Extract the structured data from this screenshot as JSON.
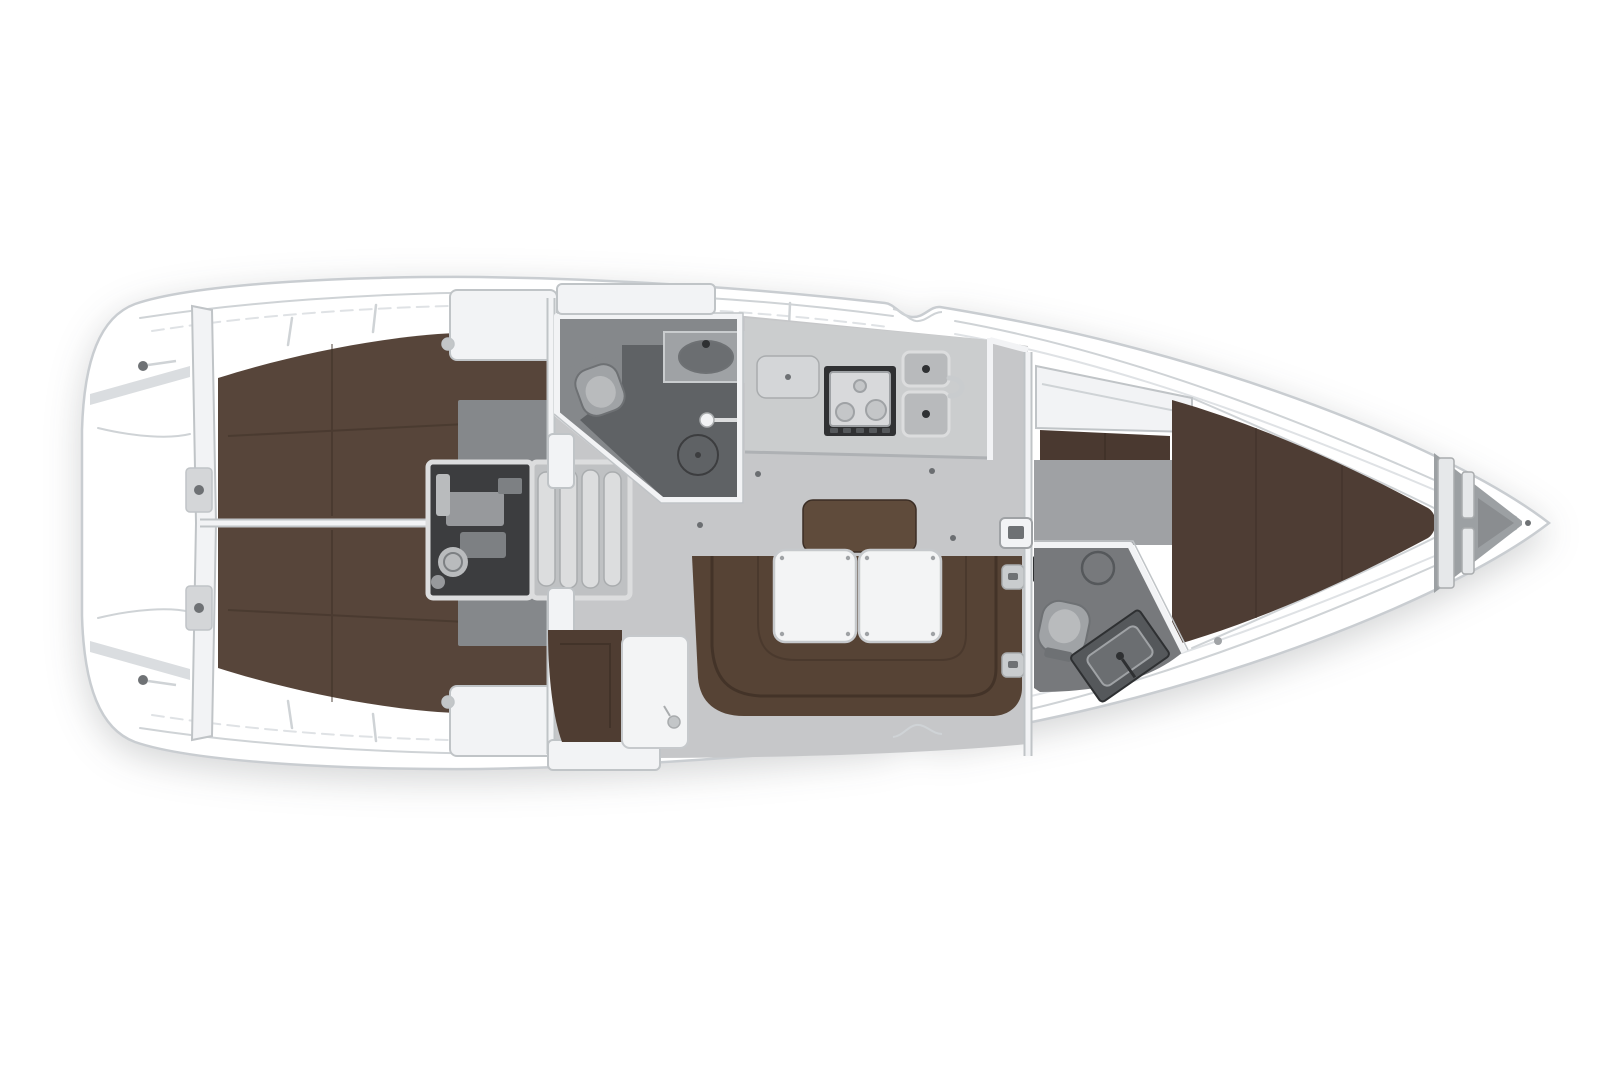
{
  "figure": {
    "type": "yacht-floor-plan",
    "title": "Sailing yacht interior layout plan, top view, bow pointing right",
    "orientation": "bow-right"
  },
  "areas": {
    "transom_platform": "transom-swim-platform",
    "aft_cabin_port": "aft-cabin-port-berth",
    "aft_cabin_starboard": "aft-cabin-starboard-berth",
    "engine_room": "engine-compartment",
    "companionway": "companionway-steps",
    "aft_head": "aft-head-with-shower",
    "galley": "galley-stove-and-sink",
    "salon": "salon-u-settee-with-tables",
    "chart_table": "chart-table-and-seat",
    "forward_head": "forward-head",
    "forward_cabin": "forward-v-berth-cabin",
    "anchor_locker": "anchor-locker"
  },
  "colors": {
    "page_bg": "#ffffff",
    "hull_white": "#ffffff",
    "hull_outline": "#c9cdd1",
    "deck_line": "#cfd3d6",
    "deck_line_soft": "#dfe2e5",
    "bulwark": "#dadde0",
    "bed_brown": "#57453a",
    "bed_seam": "#3c2e25",
    "fwd_bed_brown": "#4e3d34",
    "wardrobe_brown": "#4a3930",
    "settee_brown": "#564335",
    "settee_seam": "#392b22",
    "backrest_brown": "#5d4939",
    "chart_seat_brown": "#4f3d32",
    "salon_floor": "#c6c7c9",
    "cabin_floor_gray": "#85888b",
    "fwd_floor_gray": "#9fa1a4",
    "head_floor": "#85888b",
    "shower_floor": "#5f6265",
    "fwd_head_floor": "#77797c",
    "galley_counter": "#cbcdce",
    "galley_front": "#aeb1b4",
    "locker_gray": "#d4d6d8",
    "stove_frame": "#303133",
    "stove_top": "#d8d9db",
    "burner": "#c4c6c8",
    "burner_ring": "#9fa2a5",
    "sink_gray": "#b8babc",
    "sink_drain": "#2f3133",
    "engine_dark": "#3c3d3f",
    "engine_part": "#97999c",
    "engine_part2": "#7d8083",
    "engine_circle": "#b9bbbd",
    "steps_base": "#bfc1c3",
    "step_fill": "#dcddde",
    "step_edge": "#a9acae",
    "wall_white": "#f2f3f5",
    "wall_edge": "#c0c4c7",
    "fixture_gray": "#a0a3a6",
    "fixture_dark": "#6e7174",
    "vanity_gray": "#9fa2a5",
    "vanity_dark": "#55585b",
    "sink_bowl": "#6b6e71",
    "table_white": "#f3f4f5",
    "table_edge": "#c6c9cc",
    "anchor_gray": "#9ca0a3",
    "anchor_inner": "#8a8d90",
    "locker_bar": "#e6e8ea",
    "hinge_gray": "#c9ccce",
    "slot_dark": "#2e3032",
    "knob_gray": "#c3c6c8",
    "cleat_dark": "#6f7275",
    "dot_dark": "#6b6e71"
  }
}
